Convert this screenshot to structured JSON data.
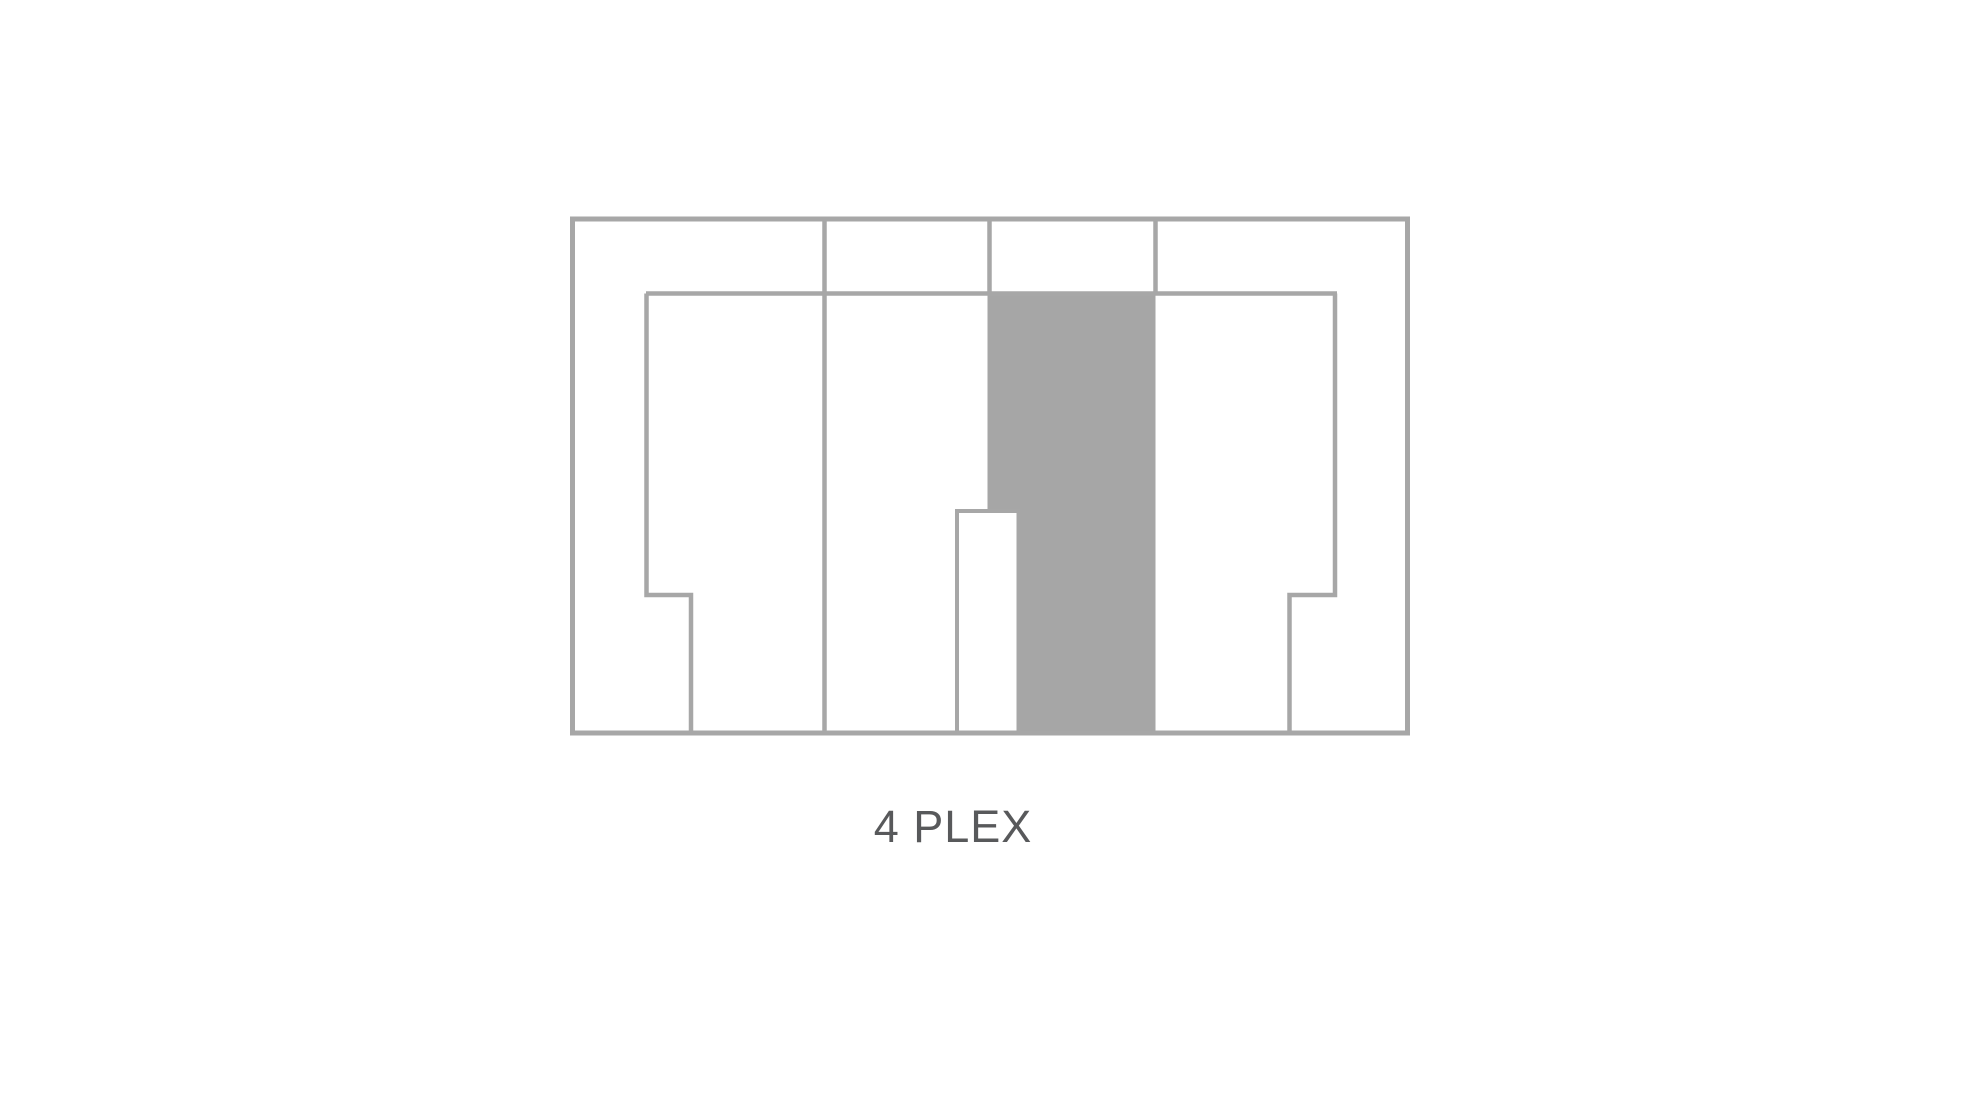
{
  "diagram": {
    "type": "floorplan",
    "title": "4 PLEX",
    "units": 4,
    "colors": {
      "background": "#ffffff",
      "wall": "#a7a7a7",
      "core_fill": "#a6a6a6",
      "title_text": "#58595b"
    }
  }
}
